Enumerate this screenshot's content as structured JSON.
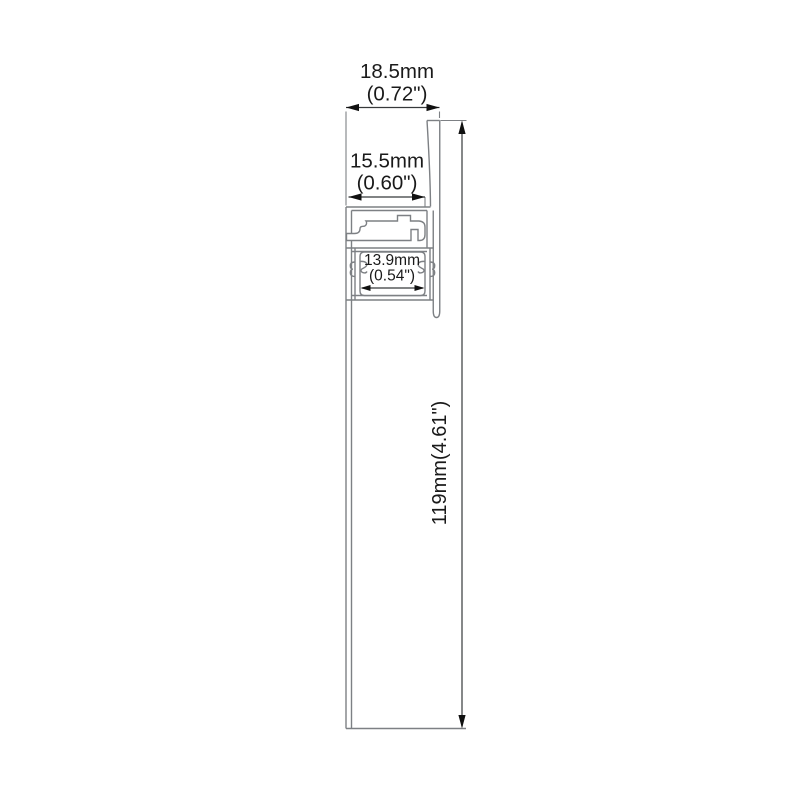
{
  "drawing": {
    "description": "LED aluminium profile cross-section technical drawing",
    "dim_width_outer_mm": "18.5mm",
    "dim_width_outer_in": "(0.72\")",
    "dim_width_inner_mm": "15.5mm",
    "dim_width_inner_in": "(0.60\")",
    "dim_channel_mm": "13.9mm",
    "dim_channel_in": "(0.54\")",
    "dim_height_total": "119mm(4.61\")"
  },
  "colors": {
    "background": "#ffffff",
    "profile_line": "#7d8084",
    "dimension_line": "#36393b",
    "arrow": "#101010",
    "text": "#1a1a1a"
  }
}
